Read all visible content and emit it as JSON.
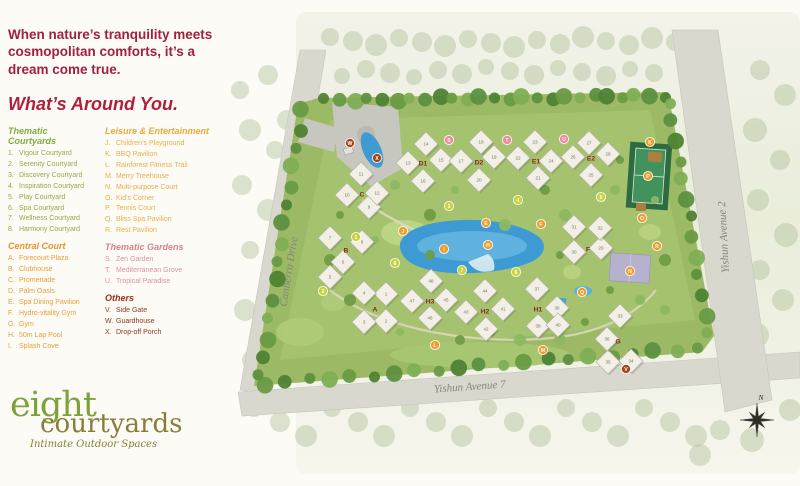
{
  "headline": "When nature’s tranquility meets cosmopolitan comforts, it’s a dream come true.",
  "section_title": "What’s Around You.",
  "legend": {
    "categories": [
      {
        "title": "Thematic Courtyards",
        "color": "#7fae3d",
        "item_color": "#9fa548",
        "items": [
          [
            "1.",
            "Vigour Courtyard"
          ],
          [
            "2.",
            "Serenity Courtyard"
          ],
          [
            "3.",
            "Discovery Courtyard"
          ],
          [
            "4.",
            "Inspiration Courtyard"
          ],
          [
            "5.",
            "Play Courtyard"
          ],
          [
            "6.",
            "Spa Courtyard"
          ],
          [
            "7.",
            "Wellness Courtyard"
          ],
          [
            "8.",
            "Harmony Courtyard"
          ]
        ]
      },
      {
        "title": "Central Court",
        "color": "#e2952f",
        "item_color": "#e6a03b",
        "items": [
          [
            "A.",
            "Forecourt Plaza"
          ],
          [
            "B.",
            "Clubhouse"
          ],
          [
            "C.",
            "Promenade"
          ],
          [
            "D.",
            "Palm Oasis"
          ],
          [
            "E.",
            "Spa Dining Pavilion"
          ],
          [
            "F.",
            "Hydro-vitality Gym"
          ],
          [
            "G.",
            "Gym"
          ],
          [
            "H.",
            "50m Lap Pool"
          ],
          [
            "I.",
            "Splash Cove"
          ]
        ]
      },
      {
        "title": "Leisure & Entertainment",
        "color": "#eaa93e",
        "item_color": "#e8af4a",
        "items": [
          [
            "J.",
            "Children’s Playground"
          ],
          [
            "K.",
            "BBQ Pavilion"
          ],
          [
            "L.",
            "Rainforest Fitness Trail"
          ],
          [
            "M.",
            "Merry Treehouse"
          ],
          [
            "N.",
            "Multi-purpose Court"
          ],
          [
            "O.",
            "Kid’s Corner"
          ],
          [
            "P.",
            "Tennis Court"
          ],
          [
            "Q.",
            "Bliss Spa Pavilion"
          ],
          [
            "R.",
            "Rest Pavilion"
          ]
        ]
      },
      {
        "title": "Thematic Gardens",
        "color": "#d9808f",
        "item_color": "#dd93a0",
        "items": [
          [
            "S.",
            "Zen Garden"
          ],
          [
            "T.",
            "Mediterranean Grove"
          ],
          [
            "U.",
            "Tropical Paradise"
          ]
        ]
      },
      {
        "title": "Others",
        "color": "#96301d",
        "item_color": "#8d3a23",
        "items": [
          [
            "V.",
            "Side Gate"
          ],
          [
            "W.",
            "Guardhouse"
          ],
          [
            "X.",
            "Drop-off Porch"
          ]
        ]
      }
    ]
  },
  "logo": {
    "name_top": "eight",
    "name_bottom": "courtyards",
    "tagline": "Intimate Outdoor Spaces"
  },
  "map": {
    "road_labels": [
      {
        "text": "Canberra Drive",
        "x": 292,
        "y": 272,
        "rotate": -81
      },
      {
        "text": "Yishun Avenue 7",
        "x": 470,
        "y": 390,
        "rotate": -4
      },
      {
        "text": "Yishun Avenue 2",
        "x": 727,
        "y": 237,
        "rotate": -93
      }
    ],
    "compass_label": "N",
    "area_labels": [
      [
        "A",
        375,
        309
      ],
      [
        "B",
        346,
        250
      ],
      [
        "C",
        362,
        194
      ],
      [
        "D1",
        423,
        163
      ],
      [
        "D2",
        479,
        162
      ],
      [
        "E1",
        536,
        161
      ],
      [
        "E2",
        591,
        158
      ],
      [
        "F",
        588,
        249
      ],
      [
        "G",
        618,
        341
      ],
      [
        "H1",
        538,
        309
      ],
      [
        "H2",
        485,
        311
      ],
      [
        "H3",
        430,
        301
      ]
    ],
    "buildings": [
      [
        "1",
        386,
        294
      ],
      [
        "2",
        386,
        321
      ],
      [
        "3",
        364,
        322
      ],
      [
        "4",
        364,
        293
      ],
      [
        "5",
        330,
        277
      ],
      [
        "6",
        343,
        262
      ],
      [
        "7",
        330,
        238
      ],
      [
        "8",
        362,
        242
      ],
      [
        "9",
        369,
        207
      ],
      [
        "10",
        347,
        195
      ],
      [
        "11",
        361,
        174
      ],
      [
        "12",
        377,
        193
      ],
      [
        "13",
        408,
        163
      ],
      [
        "14",
        426,
        144
      ],
      [
        "15",
        441,
        160
      ],
      [
        "16",
        423,
        181
      ],
      [
        "17",
        461,
        161
      ],
      [
        "18",
        481,
        142
      ],
      [
        "19",
        494,
        157
      ],
      [
        "20",
        479,
        180
      ],
      [
        "21",
        538,
        178
      ],
      [
        "22",
        518,
        158
      ],
      [
        "23",
        535,
        142
      ],
      [
        "24",
        551,
        161
      ],
      [
        "25",
        591,
        175
      ],
      [
        "26",
        573,
        157
      ],
      [
        "27",
        589,
        143
      ],
      [
        "28",
        608,
        154
      ],
      [
        "29",
        601,
        248
      ],
      [
        "30",
        574,
        252
      ],
      [
        "31",
        574,
        227
      ],
      [
        "32",
        600,
        228
      ],
      [
        "33",
        620,
        316
      ],
      [
        "34",
        631,
        361
      ],
      [
        "35",
        608,
        362
      ],
      [
        "36",
        607,
        339
      ],
      [
        "37",
        537,
        289
      ],
      [
        "38",
        557,
        308
      ],
      [
        "39",
        538,
        326
      ],
      [
        "40",
        558,
        325
      ],
      [
        "41",
        503,
        309
      ],
      [
        "42",
        486,
        329
      ],
      [
        "43",
        466,
        312
      ],
      [
        "44",
        485,
        291
      ],
      [
        "45",
        446,
        300
      ],
      [
        "46",
        430,
        318
      ],
      [
        "47",
        412,
        301
      ],
      [
        "48",
        431,
        281
      ]
    ],
    "markers": {
      "courtyard": [
        [
          "1",
          356,
          237
        ],
        [
          "2",
          323,
          291
        ],
        [
          "3",
          449,
          206
        ],
        [
          "4",
          518,
          200
        ],
        [
          "5",
          601,
          197
        ],
        [
          "6",
          516,
          272
        ],
        [
          "7",
          462,
          270
        ],
        [
          "8",
          395,
          263
        ]
      ],
      "facility": [
        [
          "E",
          486,
          223
        ],
        [
          "F",
          541,
          224
        ],
        [
          "H",
          488,
          245
        ],
        [
          "I",
          444,
          249
        ],
        [
          "J",
          403,
          231
        ],
        [
          "K",
          650,
          142
        ],
        [
          "L",
          435,
          345
        ],
        [
          "M",
          543,
          350
        ],
        [
          "N",
          630,
          271
        ],
        [
          "O",
          642,
          218
        ],
        [
          "P",
          648,
          176
        ],
        [
          "Q",
          582,
          292
        ],
        [
          "R",
          657,
          246
        ]
      ],
      "garden": [
        [
          "S",
          449,
          140
        ],
        [
          "T",
          507,
          140
        ],
        [
          "U",
          564,
          139
        ]
      ],
      "other": [
        [
          "V",
          626,
          369
        ],
        [
          "W",
          350,
          143
        ],
        [
          "X",
          377,
          158
        ]
      ]
    },
    "marker_colors": {
      "courtyard": "#c9d23c",
      "facility": "#ef9c2c",
      "garden": "#ef8a9d",
      "other": "#a2451c"
    }
  }
}
